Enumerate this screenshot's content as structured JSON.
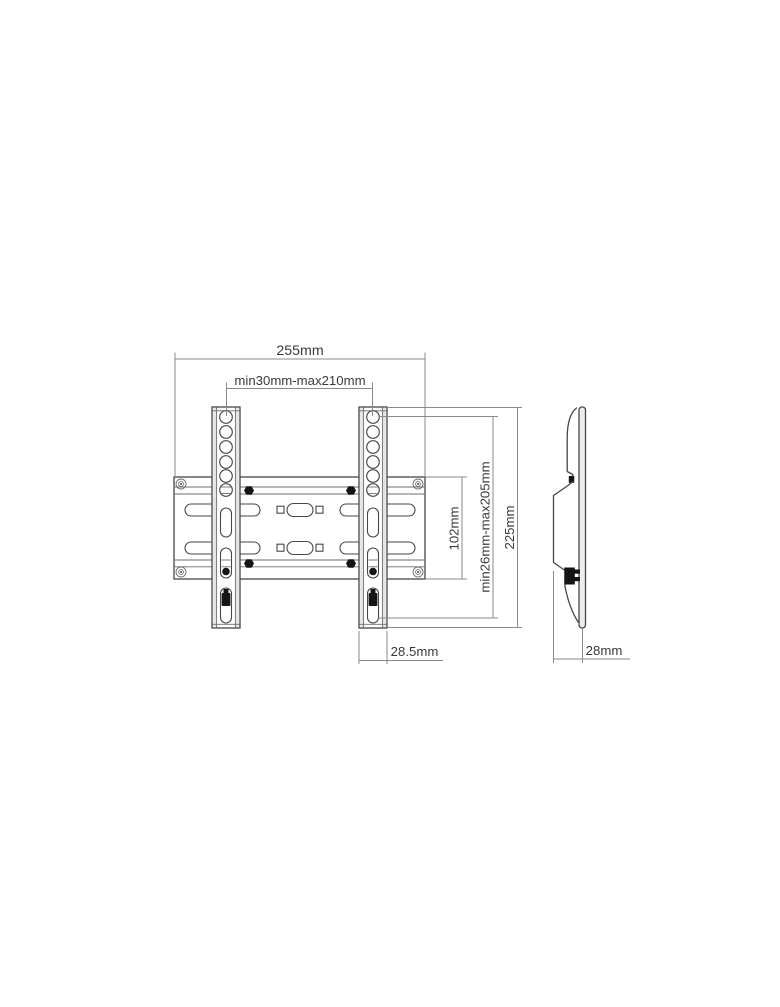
{
  "drawing": {
    "dimensions": {
      "overall_width": "255mm",
      "mount_width_range": "min30mm-max210mm",
      "plate_height": "102mm",
      "mount_height_range": "min26mm-max205mm",
      "overall_height": "225mm",
      "rail_width": "28.5mm",
      "depth": "28mm"
    },
    "colors": {
      "object_line": "#464646",
      "thin_line": "#6e6e6e",
      "dimension_line": "#8a8a8a",
      "text": "#3a3a3a",
      "hardware_fill": "#151515",
      "background": "#ffffff"
    }
  }
}
